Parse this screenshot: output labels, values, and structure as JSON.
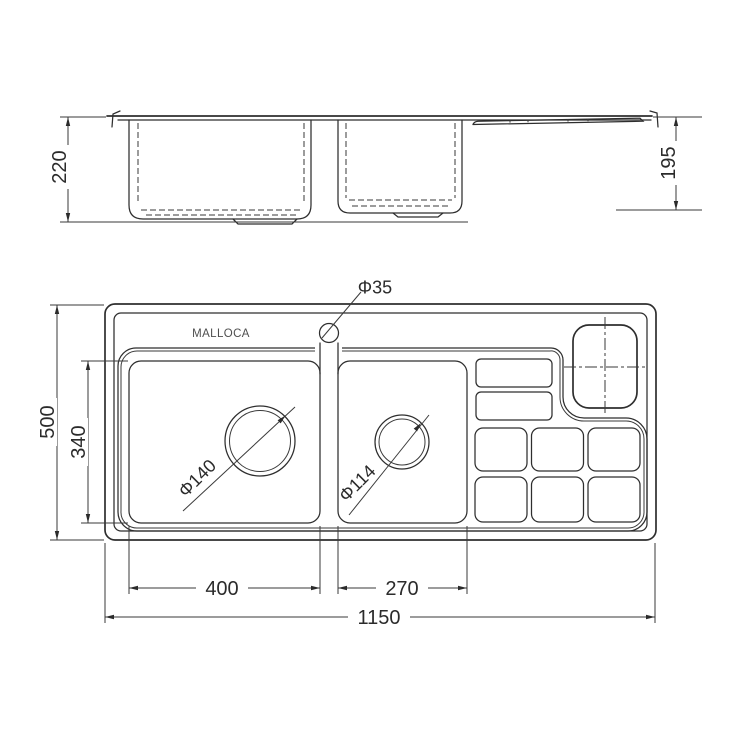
{
  "drawing": {
    "brand_label": "MALLOCA",
    "labels": {
      "faucet_hole_diameter": "Φ35",
      "left_drain_diameter": "Φ140",
      "right_drain_diameter": "Φ114"
    },
    "dimensions": {
      "side_total_height": "220",
      "side_right_depth": "195",
      "plan_total_depth": "500",
      "plan_bowl_depth": "340",
      "plan_left_bowl_width": "400",
      "plan_right_bowl_width": "270",
      "plan_total_width": "1150"
    }
  }
}
